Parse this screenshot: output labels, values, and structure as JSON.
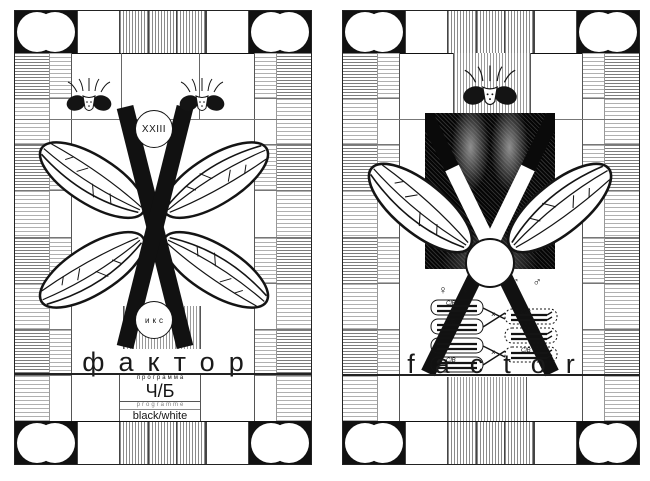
{
  "artwork": {
    "type": "poster-diptych",
    "style": "black-and-white TV test-card posters with fly (Drosophila) imagery and X-letter motif"
  },
  "colors": {
    "paper": "#ffffff",
    "ink": "#141414",
    "grid_line": "#6b6b6b",
    "hatch": "#9e9e9e"
  },
  "left_poster": {
    "roman_numeral": "XXIII",
    "circle_label": "икс",
    "title": "фактор",
    "program_label_ru": "программа",
    "program_value": "Ч/Б",
    "program_label_en": "programme",
    "program_value_en": "black/white"
  },
  "right_poster": {
    "title": "factor",
    "female_symbols": "♀ ♀",
    "male_symbols": "♂ ♂",
    "clb_label": "ClB",
    "cross_mark": "×"
  }
}
